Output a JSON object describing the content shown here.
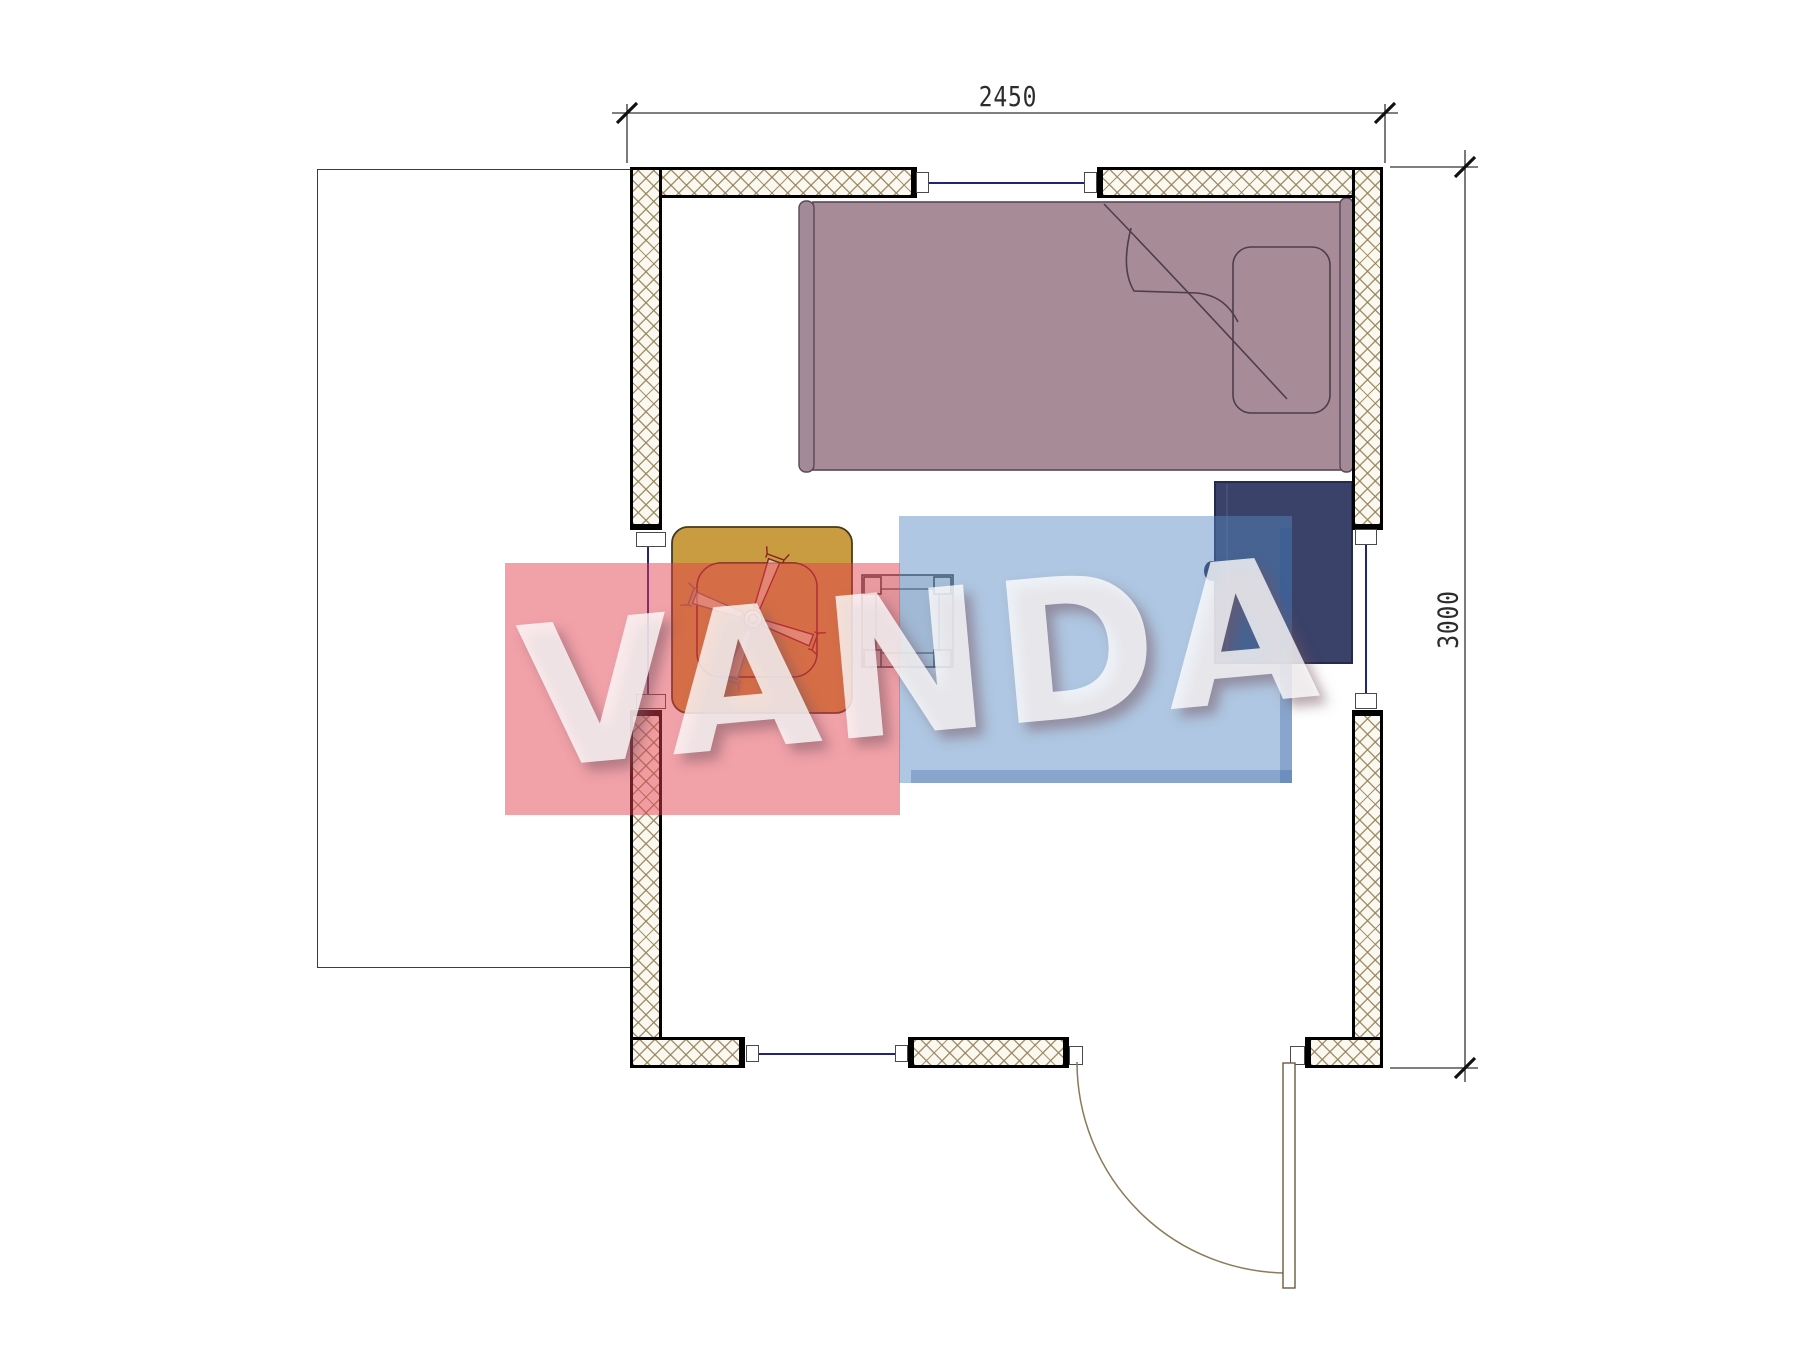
{
  "drawing": {
    "type": "floor-plan",
    "dimensions": {
      "width_label": "2450",
      "height_label": "3000"
    },
    "watermark": {
      "text": "VANDA",
      "red_square_color": "#e23e4c",
      "blue_square_color": "#5688c1",
      "letter_color": "#ffffff"
    },
    "colors": {
      "bed_fill": "#a78c98",
      "cabinet_fill": "#3a4269",
      "table_fill": "#c99c42",
      "wall_hatch_line": "#94825c",
      "wall_outline": "#000000",
      "window_glass_line": "#23237a",
      "dimension_line": "#333333"
    },
    "objects": [
      {
        "name": "lot-boundary"
      },
      {
        "name": "single-bed",
        "parts": [
          "mattress",
          "pillow",
          "blanket-fold",
          "headboard-rail",
          "footboard-rail"
        ]
      },
      {
        "name": "bedside-cabinet",
        "parts": [
          "door-line",
          "knob"
        ]
      },
      {
        "name": "square-table"
      },
      {
        "name": "ceiling-fan-symbol",
        "blades": 4
      },
      {
        "name": "stool"
      },
      {
        "name": "door",
        "parts": [
          "leaf",
          "swing-arc"
        ]
      },
      {
        "name": "window-top"
      },
      {
        "name": "window-left"
      },
      {
        "name": "window-right"
      },
      {
        "name": "window-bottom"
      }
    ]
  }
}
